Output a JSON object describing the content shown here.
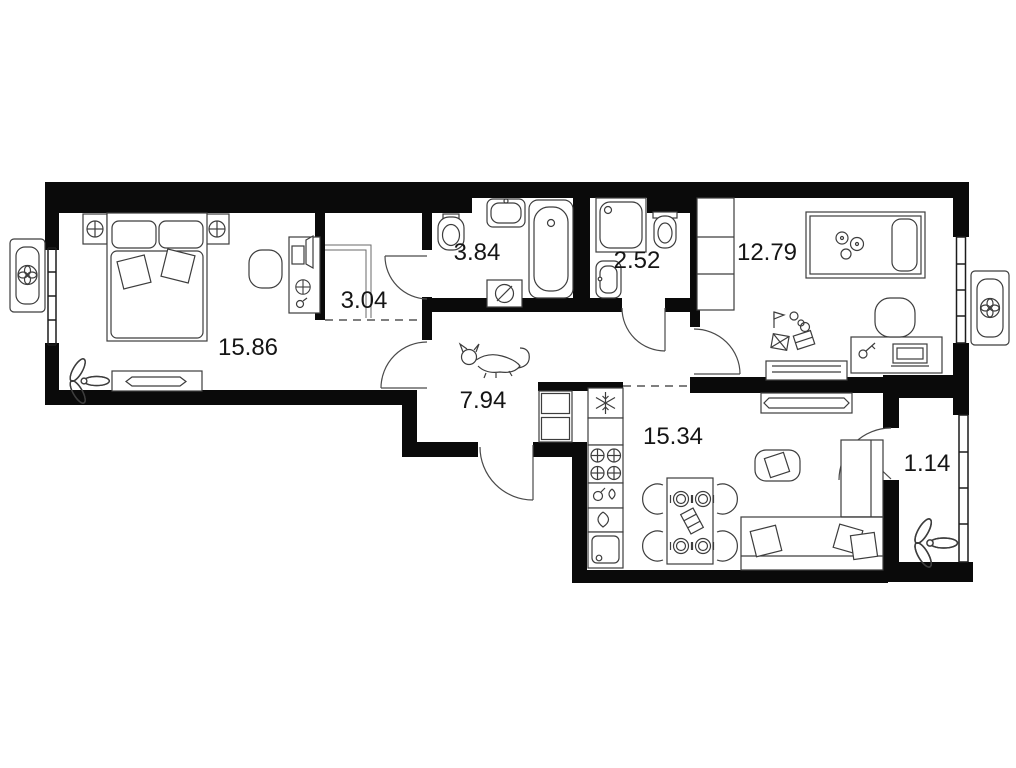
{
  "plan": {
    "type": "apartment-floor-plan",
    "area_units": "m2",
    "rooms": [
      {
        "name": "bedroom",
        "area_label": "15.86"
      },
      {
        "name": "wardrobe-niche",
        "area_label": "3.04"
      },
      {
        "name": "bathroom",
        "area_label": "3.84"
      },
      {
        "name": "toilet-room",
        "area_label": "2.52"
      },
      {
        "name": "kids-room",
        "area_label": "12.79"
      },
      {
        "name": "hallway",
        "area_label": "7.94"
      },
      {
        "name": "kitchen-living-room",
        "area_label": "15.34"
      },
      {
        "name": "balcony",
        "area_label": "1.14"
      }
    ],
    "colors": {
      "walls": "#0a0a0a",
      "furniture_line": "#3d3d3d",
      "background": "#ffffff",
      "label_text": "#151515"
    },
    "icons": [
      "snowflake-icon",
      "fan-icon",
      "burner-icon",
      "lamp-icon",
      "plate-icon",
      "plant-icon",
      "cat-icon"
    ],
    "furniture": {
      "bedroom": [
        "double-bed",
        "nightstand-left",
        "nightstand-right",
        "desk",
        "desk-chair",
        "tv-console",
        "plant"
      ],
      "bathroom": [
        "toilet",
        "sink",
        "bathtub",
        "washing-machine"
      ],
      "toilet-room": [
        "shower",
        "toilet",
        "sink"
      ],
      "kids-room": [
        "wardrobe",
        "single-bed",
        "toys",
        "desk",
        "chair",
        "dresser"
      ],
      "hallway": [
        "cabinet",
        "cat"
      ],
      "kitchen-living-room": [
        "fridge",
        "stove",
        "counter",
        "kitchen-sink",
        "dining-table",
        "chairs",
        "pouf",
        "sofa",
        "tv-console"
      ],
      "balcony": [
        "plant"
      ]
    }
  }
}
